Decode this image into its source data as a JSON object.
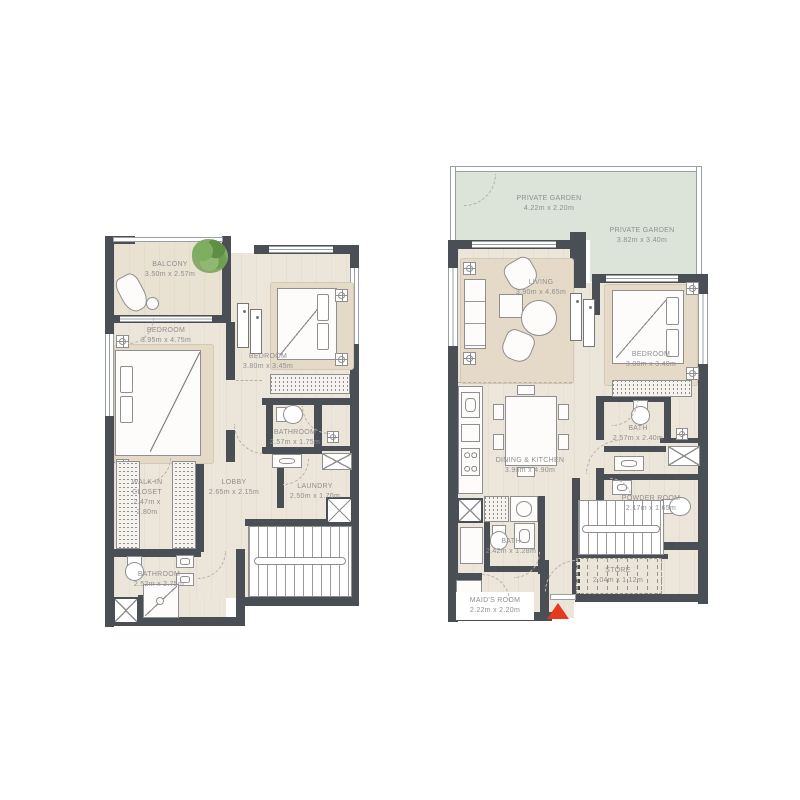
{
  "colors": {
    "wall": "#4A4F55",
    "floor": "#ECE5D9",
    "floor_accent": "#E4DAC7",
    "garden": "#DCE3D8",
    "label_text": "#8F8F8F",
    "entry_marker": "#E8381F",
    "plant": "#7AA45B"
  },
  "plans": {
    "left": {
      "balcony": {
        "name": "BALCONY",
        "dims": "3.50m x 2.57m"
      },
      "bedroom1": {
        "name": "BEDROOM",
        "dims": "3.95m x 4.75m"
      },
      "bedroom2": {
        "name": "BEDROOM",
        "dims": "3.80m x 3.45m"
      },
      "bathroom1": {
        "name": "BATHROOM",
        "dims": "2.57m x 1.75m"
      },
      "laundry": {
        "name": "LAUNDRY",
        "dims": "2.50m x 1.70m"
      },
      "walkin_closet": {
        "name": "WALK-IN CLOSET",
        "dims": "2.47m x 2.80m"
      },
      "lobby": {
        "name": "LOBBY",
        "dims": "2.65m x 2.15m"
      },
      "bathroom2": {
        "name": "BATHROOM",
        "dims": "2.52m x 2.75m"
      }
    },
    "right": {
      "garden1": {
        "name": "PRIVATE GARDEN",
        "dims": "4.22m x 2.20m"
      },
      "garden2": {
        "name": "PRIVATE GARDEN",
        "dims": "3.82m x 3.40m"
      },
      "living": {
        "name": "LIVING",
        "dims": "3.90m x 4.65m"
      },
      "bedroom": {
        "name": "BEDROOM",
        "dims": "3.80m x 3.40m"
      },
      "dining_kitchen": {
        "name": "DINING & KITCHEN",
        "dims": "3.90m x 4.90m"
      },
      "bath": {
        "name": "BATH",
        "dims": "2.57m x 2.40m"
      },
      "powder": {
        "name": "POWDER ROOM",
        "dims": "2.17m x 1.65m"
      },
      "bath_small": {
        "name": "BATH",
        "dims": "2.42m x 1.28m"
      },
      "maids_room": {
        "name": "MAID'S ROOM",
        "dims": "2.22m x 2.20m"
      },
      "store": {
        "name": "STORE",
        "dims": "2.04m x 1.12m"
      }
    }
  },
  "entry_marker": {
    "type": "triangle",
    "color": "#E8381F"
  }
}
